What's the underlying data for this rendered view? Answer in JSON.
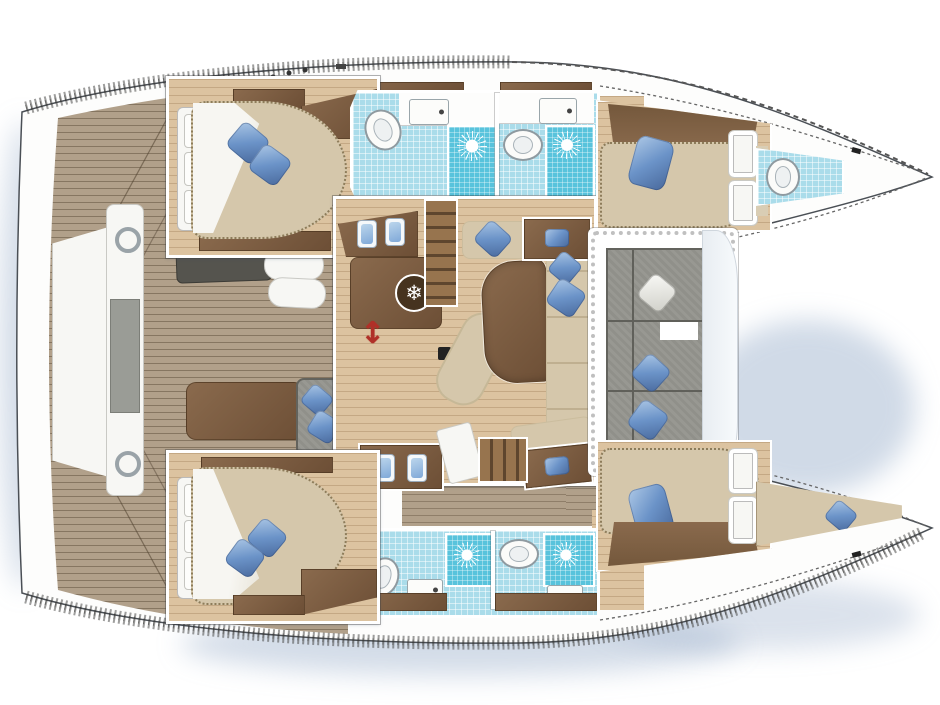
{
  "diagram": {
    "type": "catamaran-floor-plan",
    "orientation": "bows-pointing-right",
    "decor": {
      "blue_pillow_total_count": 14,
      "white_pillow_count": 1,
      "shower_sun_icon_count": 4,
      "fridge_icon": "snowflake",
      "companionway_marker": "red-double-arrow"
    },
    "port_hull": {
      "aft_cabin": {
        "bed": "double-island",
        "blue_pillows": 2,
        "headboard_pillows": 3
      },
      "bathrooms": [
        {
          "fixtures": [
            "sink",
            "toilet",
            "shower"
          ]
        },
        {
          "fixtures": [
            "sink",
            "toilet",
            "shower"
          ]
        }
      ],
      "forward_cabin": {
        "bed": "double",
        "blue_pillows": 1,
        "doors": 2
      },
      "bow_compartment": {
        "fixtures": [
          "toilet"
        ]
      }
    },
    "starboard_hull": {
      "aft_cabin": {
        "bed": "double-island",
        "blue_pillows": 2,
        "headboard_pillows": 3
      },
      "bathrooms": [
        {
          "fixtures": [
            "sink",
            "toilet",
            "shower"
          ]
        },
        {
          "fixtures": [
            "sink",
            "toilet",
            "shower"
          ]
        }
      ],
      "forward_cabin": {
        "bed": "double",
        "blue_pillows": 1,
        "doors": 2
      },
      "bow_compartment": {
        "berth_blue_pillows": 1
      }
    },
    "salon": {
      "galley": {
        "sinks": 2,
        "fridge": true,
        "stair_flights": 2
      },
      "dining_table": 1,
      "chaise_longue": 1,
      "sofa_blue_pillows": 3,
      "side_tables_with_cushion": 2,
      "mast_step": true,
      "sliding_door_marker": true
    },
    "aft_cockpit": {
      "dark_bench": 1,
      "white_seats": 2,
      "brown_bench": 1,
      "chair_blue_pillows": 2,
      "center_beam_hatches": 2,
      "gray_pad": 1
    },
    "forward_cockpit": {
      "gray_cushion_sections": 3,
      "blue_pillows": 2,
      "white_pillows": 1,
      "sunpad": 1
    }
  },
  "colors": {
    "teak": "#b1a08a",
    "wood": "#dcc3a0",
    "brown": "#8a6a4d",
    "brown_dark": "#6d4f36",
    "beige": "#d5c7ab",
    "tile": "#aadcea",
    "shower": "#58c3dc",
    "pillow": "#6b93c8",
    "pillow_dark": "#49699c",
    "cushion": "#90908a",
    "bench_dark": "#55544e",
    "hull": "#fdfdfc",
    "outline": "#4a4f55",
    "accent_red": "#b03028"
  }
}
